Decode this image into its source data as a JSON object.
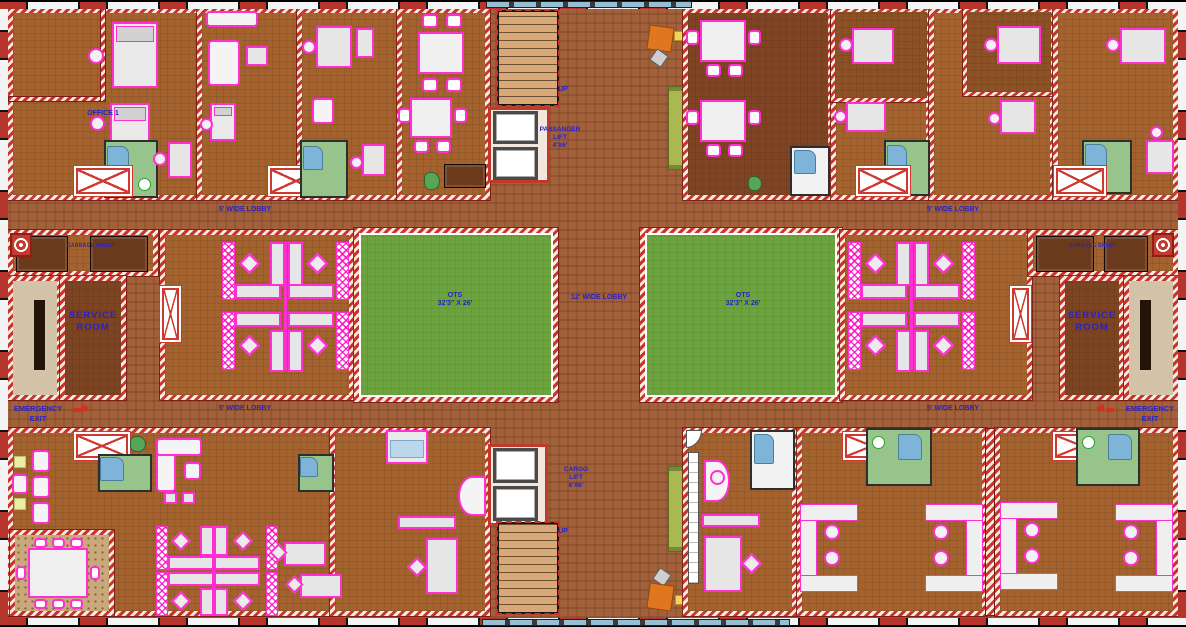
{
  "plan": {
    "rooms": {
      "office1": "OFFICE 1",
      "service_line1": "SERVICE",
      "service_line2": "ROOM",
      "garbage_shoot": "GARBAGE SHOOT"
    },
    "lobbies": {
      "side": "5' WIDE LOBBY",
      "center": "12' WIDE LOBBY"
    },
    "ots": {
      "name": "OTS",
      "size": "32'3\" X 26'"
    },
    "lifts": {
      "passenger": {
        "l1": "PASSANGER",
        "l2": "LIFT",
        "l3": "4'X6'"
      },
      "cargo": {
        "l1": "CARGO",
        "l2": "LIFT",
        "l3": "6'X6'"
      }
    },
    "stairs": {
      "up": "UP"
    },
    "exit": {
      "l1": "EMERGENCY",
      "l2": "EXIT"
    },
    "colors": {
      "wall_red": "#c8352c",
      "floor_brown": "#a4622f",
      "lobby_brown": "#a2613a",
      "ots_green": "#6da33e",
      "bath_green": "#97c48b",
      "water_blue": "#7fb4d9",
      "furniture_magenta": "#ff2fd2",
      "label_blue": "#2a21c4",
      "service_brown": "#7c4423",
      "stair_tan": "#d8a877",
      "desk_orange": "#e0771f",
      "bench_olive": "#a9b94f",
      "glazing_blue": "#97bfd4"
    }
  }
}
